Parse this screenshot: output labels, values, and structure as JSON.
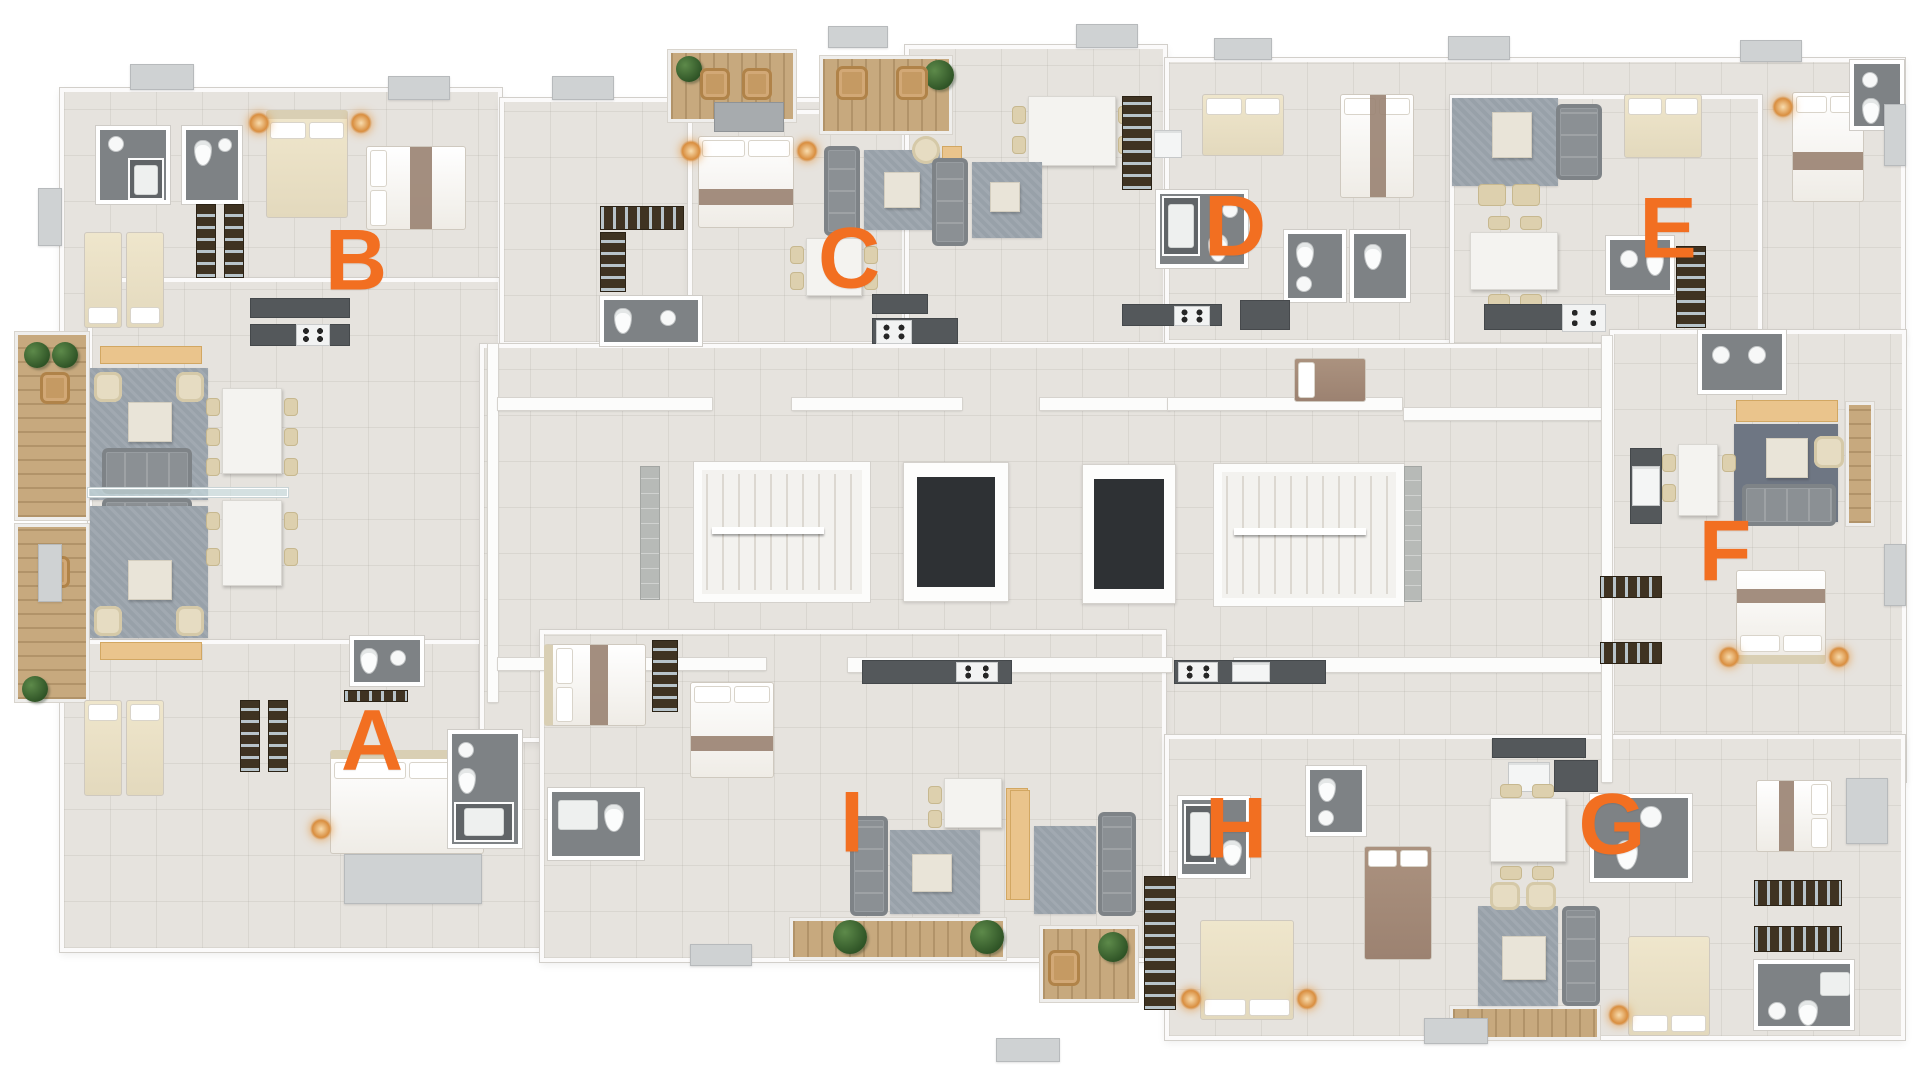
{
  "canvas": {
    "width": 1920,
    "height": 1079,
    "background": "#ffffff"
  },
  "plan": {
    "type": "apartment-building-floor-plan",
    "units": [
      {
        "label": "A",
        "x": 372,
        "y": 744
      },
      {
        "label": "B",
        "x": 356,
        "y": 264
      },
      {
        "label": "C",
        "x": 849,
        "y": 262
      },
      {
        "label": "D",
        "x": 1235,
        "y": 230
      },
      {
        "label": "E",
        "x": 1668,
        "y": 232
      },
      {
        "label": "F",
        "x": 1725,
        "y": 555
      },
      {
        "label": "G",
        "x": 1612,
        "y": 828
      },
      {
        "label": "H",
        "x": 1236,
        "y": 832
      },
      {
        "label": "I",
        "x": 852,
        "y": 826
      }
    ],
    "core": {
      "stairwells": 2,
      "elevators": 2
    },
    "palette": {
      "accent": "#f26f21",
      "floor": "#e6e3de",
      "wall": "#fcfcfb",
      "bath_tile": "#7e8285",
      "shower_tile": "#606467",
      "kitchen_counter": "#54585b",
      "balcony_wood": "#c7a97e",
      "plant": "#2f5426",
      "sofa": "#8b9094",
      "rug": "#98a1a9",
      "bed_beige": "#eadfc6",
      "bed_white": "#f6f4f0",
      "bed_runner": "#9b8474",
      "wardrobe": "#3f3322",
      "elevator_cab": "#2e3134",
      "lamp_glow": "#d98e3f"
    }
  }
}
